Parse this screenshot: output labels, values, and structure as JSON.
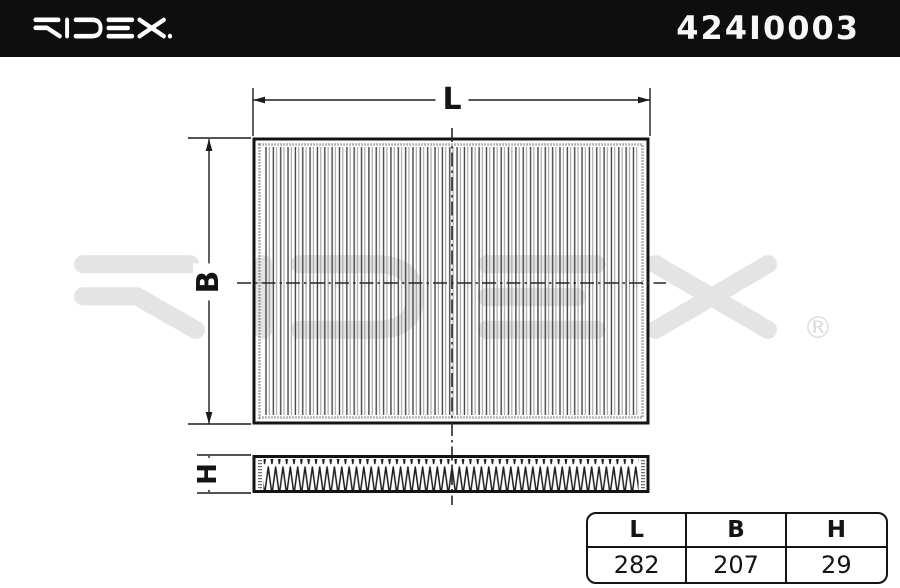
{
  "header": {
    "brand": "RIDEX.",
    "part_number": "424I0003"
  },
  "watermark": {
    "brand": "RIDEX",
    "registered_symbol": "®"
  },
  "drawing": {
    "labels": {
      "length": "L",
      "width": "B",
      "height": "H"
    }
  },
  "dimensions_table": {
    "columns": [
      "L",
      "B",
      "H"
    ],
    "values": [
      "282",
      "207",
      "29"
    ]
  },
  "colors": {
    "header_bg": "#0e0e0e",
    "line": "#141414",
    "watermark": "#e4e4e4"
  }
}
